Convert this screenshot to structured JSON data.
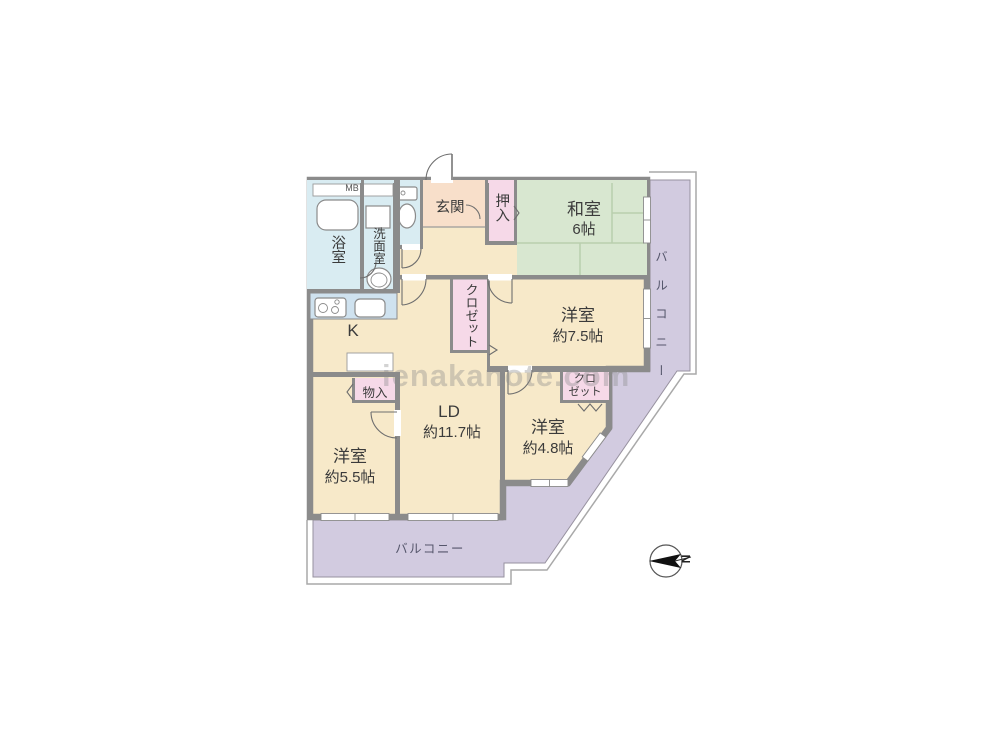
{
  "watermark": "ienakanote.com",
  "compass": {
    "north_label": "N"
  },
  "rooms": {
    "meter_box": "MB",
    "bath": "浴室",
    "washroom": "洗面室",
    "entrance": "玄関",
    "oshiire": "押入",
    "japanese_room_name": "和室",
    "japanese_room_size": "6帖",
    "closet_tall": "クロゼット",
    "western_room_1_name": "洋室",
    "western_room_1_size": "約7.5帖",
    "kitchen": "K",
    "storage": "物入",
    "living_dining_name": "LD",
    "living_dining_size": "約11.7帖",
    "western_room_2_name": "洋室",
    "western_room_2_size": "約5.5帖",
    "western_room_3_name": "洋室",
    "western_room_3_size": "約4.8帖",
    "closet_small_line1": "クロ",
    "closet_small_line2": "ゼット",
    "balcony_side": "バルコニー",
    "balcony_bottom": "バルコニー"
  },
  "colors": {
    "wall": "#8b8b8b",
    "room_beige": "#f7e9c9",
    "tatami_green": "#d8e7d0",
    "wet_area_blue": "#d9ecf2",
    "entrance_salmon": "#f8dfca",
    "closet_pink": "#f6d9e8",
    "balcony_purple": "#d2cbe0",
    "counter_blue": "#cfe2ef"
  }
}
